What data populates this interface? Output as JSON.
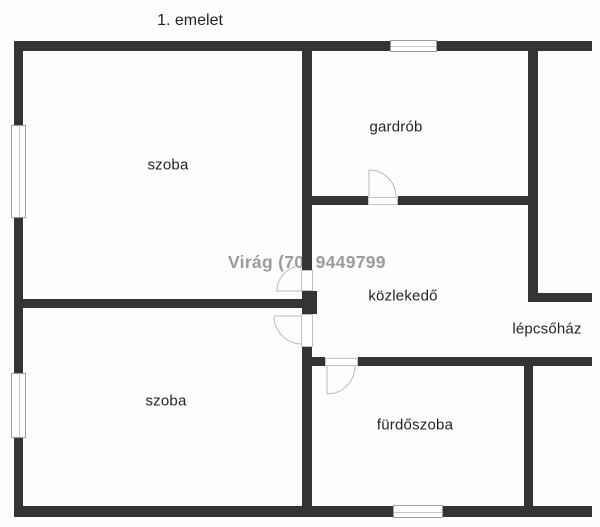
{
  "title": "1. emelet",
  "watermark": {
    "text": "Virág (70) 9449799",
    "color": "#9b9b9b"
  },
  "colors": {
    "wall": "#333436",
    "background": "#fdfdfd",
    "label_text": "#242424",
    "watermark_text": "#9b9b9b",
    "door_arc": "#b9b9b9",
    "window_border": "#9e9e9e"
  },
  "rooms": [
    {
      "id": "szoba-upper",
      "label": "szoba"
    },
    {
      "id": "gardrob",
      "label": "gardrób"
    },
    {
      "id": "kozlekedo",
      "label": "közlekedő"
    },
    {
      "id": "lepcsohaz",
      "label": "lépcsőház"
    },
    {
      "id": "szoba-lower",
      "label": "szoba"
    },
    {
      "id": "furdoszoba",
      "label": "fürdőszoba"
    }
  ]
}
